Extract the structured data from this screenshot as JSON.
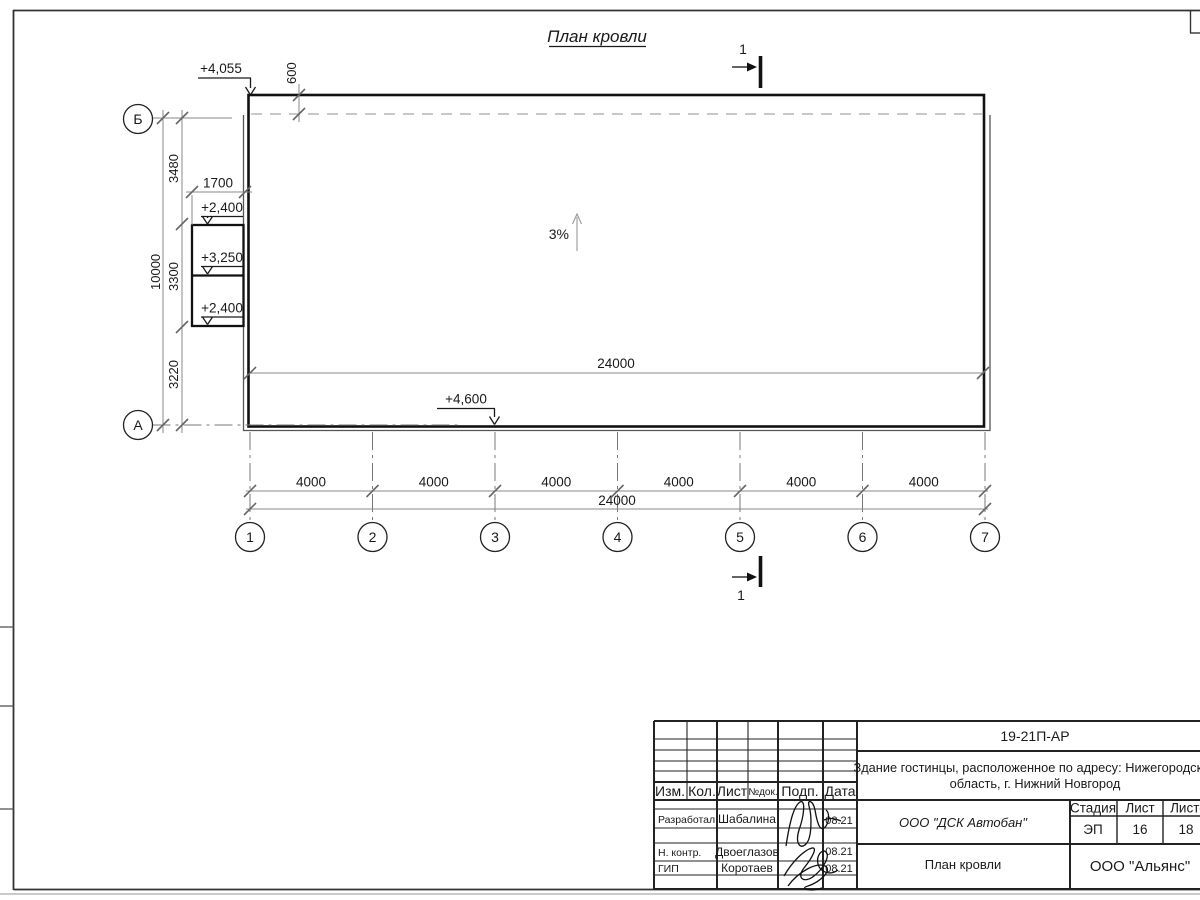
{
  "sheet": {
    "title": "План кровли",
    "slope": "3%",
    "section_label_top": "1",
    "section_label_bottom": "1",
    "axes_rows": [
      "Б",
      "А"
    ],
    "axes_cols": [
      "1",
      "2",
      "3",
      "4",
      "5",
      "6",
      "7"
    ],
    "elevations": {
      "roof_top_left": "+4,055",
      "canopy_top": "+2,400",
      "canopy_mid": "+3,250",
      "canopy_low": "+2,400",
      "roof_bottom": "+4,600"
    },
    "dims": {
      "overhang": "600",
      "canopy_width": "1700",
      "left_total": "10000",
      "left_segments": [
        "3480",
        "3300",
        "3220"
      ],
      "roof_span_inner": "24000",
      "bottom_segments": [
        "4000",
        "4000",
        "4000",
        "4000",
        "4000",
        "4000"
      ],
      "bottom_total": "24000"
    }
  },
  "title_block": {
    "doc_code": "19-21П-АР",
    "project_name_line1": "Здание гостинцы, расположенное по адресу: Нижегородская",
    "project_name_line2": "область, г. Нижний Новгород",
    "contractor": "ООО \"ДСК Автобан\"",
    "sheet_name": "План кровли",
    "organization": "ООО \"Альянс\"",
    "stage_header": "Стадия",
    "sheet_header": "Лист",
    "sheets_header": "Листов",
    "stage": "ЭП",
    "sheet_no": "16",
    "sheets_total": "18",
    "cols": {
      "izm": "Изм.",
      "kol": "Кол.",
      "list": "Лист",
      "ndok": "№док.",
      "podp": "Подп.",
      "data": "Дата"
    },
    "rows": [
      {
        "role": "Разработал",
        "name": "Шабалина",
        "date": "08.21"
      },
      {
        "role": "Н. контр.",
        "name": "Двоеглазов",
        "date": "08.21"
      },
      {
        "role": "ГИП",
        "name": "Коротаев",
        "date": "08.21"
      }
    ]
  }
}
